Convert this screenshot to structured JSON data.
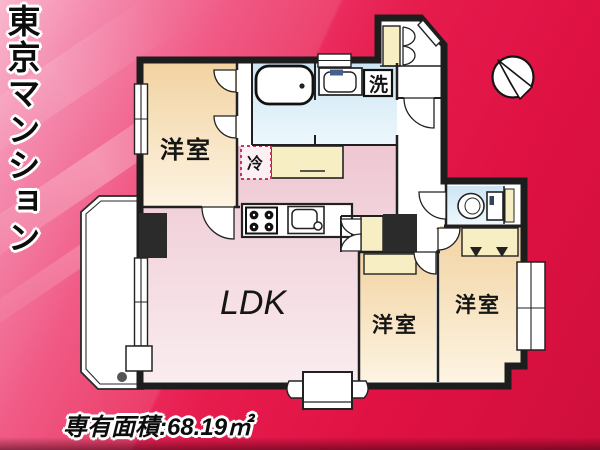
{
  "banner": {
    "title": "東京マンション"
  },
  "floorplan": {
    "rooms": {
      "bedroom_top_left": "洋室",
      "ldk": "LDK",
      "bedroom_bottom_middle": "洋室",
      "bedroom_bottom_right": "洋室"
    },
    "fixtures": {
      "refrigerator": "冷",
      "washing_machine": "洗"
    },
    "compass": "north-arrow-pointing-upper-left"
  },
  "footer": {
    "area_text": "専有面積:68.19㎡"
  },
  "colors": {
    "background_red": "#e61245",
    "background_pink": "#f9a9c3",
    "wall": "#1d1d1d",
    "room_beige": "#f3d6a6",
    "room_pink": "#eec9d3",
    "room_blue": "#cfe6f3",
    "closet_yellow": "#f8eec4",
    "fridge_dash": "#c23a5e"
  }
}
